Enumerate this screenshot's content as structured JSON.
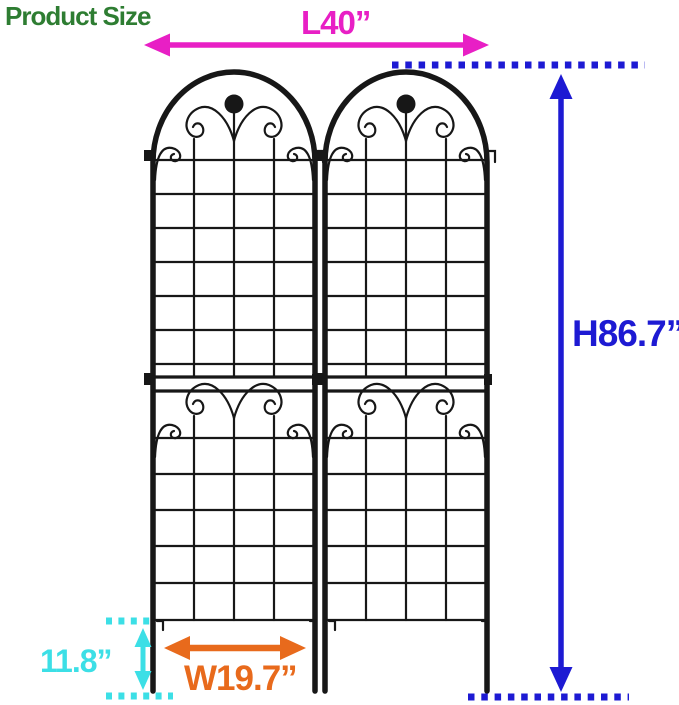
{
  "title": "Product Size",
  "annotations": {
    "length": {
      "label": "L40”"
    },
    "height": {
      "label": "H86.7”"
    },
    "ground_clearance": {
      "label": "11.8”"
    },
    "panel_width": {
      "label": "W19.7”"
    }
  },
  "figure": {
    "panel_count": 2
  },
  "colors": {
    "title": "#2e7d32",
    "length": "#e81fc5",
    "height": "#1d1ad3",
    "ground": "#3cdfe6",
    "width": "#e86a1c",
    "trellis": "#171717",
    "bg": "#ffffff"
  }
}
